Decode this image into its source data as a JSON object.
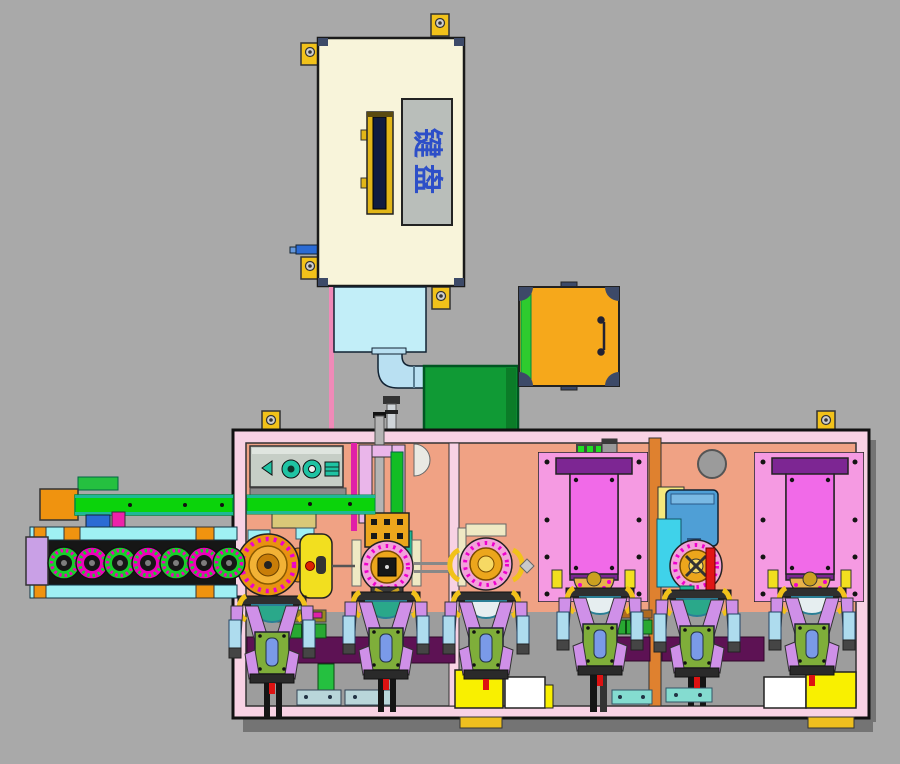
{
  "machine_label": {
    "text": "键盘"
  },
  "components": {
    "feeder": "feeder-box",
    "chute": "vibration-chute",
    "pipe": "elbow-pipe",
    "cabinet": "green-cabinet",
    "cover": "orange-cover",
    "frame": "machine-frame",
    "conveyor": "chain-conveyor",
    "press": "press-station",
    "turret": "turret-station",
    "plates": "fixture-plate",
    "grippers": "gripper-unit"
  },
  "colors": {
    "bg": "#a9a9a9",
    "shadow": "#747474",
    "frame-pink": "#f8d2e4",
    "salmon": "#f0a284",
    "gray-band": "#9d9d9d",
    "cream": "#f8f4da",
    "gold-tab": "#f2c21a",
    "rail-gold": "#e2b618",
    "navy": "#101c40",
    "label-gray": "#b9beba",
    "label-blue": "#2d4fc8",
    "chute": "#c2eef8",
    "pipe": "#b9e0f2",
    "green-box": "#109a35",
    "orange-box": "#f6a81b",
    "green-strip": "#2ecb2e",
    "slate": "#3d4a68",
    "beam-green": "#0bd30b",
    "teal": "#1fb896",
    "cyan-rail": "#9ff0f4",
    "orange-block": "#f0930f",
    "bed-dark": "#161616",
    "lavender": "#c9a0e6",
    "panel-gray": "#c6cec6",
    "comp-teal": "#1fc3a3",
    "violet-plate": "#eab6ea",
    "rod-gray": "#b4b4b4",
    "gold-part": "#eca61c",
    "station-pink": "#f2a2da",
    "dot-magenta": "#ee00cc",
    "ivory": "#efe9c4",
    "khaki": "#d9c878",
    "turret-orange": "#e89211",
    "yellow-d": "#f2df1f",
    "red": "#e01515",
    "magenta": "#e020a8",
    "plate-pink": "#f59ae2",
    "purple": "#7d2693",
    "magenta-panel": "#f16ae8",
    "led-green": "#22dd22",
    "chip-gray": "#9a9a9a",
    "bar-purple": "#5d1254",
    "gripper-violet": "#cf90e8",
    "clamp-blue": "#aedcee",
    "body-green": "#7fae3a",
    "slot-blue": "#7a9ae8",
    "cup-teal": "#2aa88a",
    "cup-light": "#e6eef0",
    "yellow-box": "#f9f000",
    "white": "#ffffff",
    "teal-plate": "#84dcd0",
    "steel-blue": "#4f9fd6",
    "cyan-block": "#3fd2ea",
    "divider-orange": "#df812f",
    "pad-gold": "#eebf1f",
    "tube-magenta": "#f08ab8",
    "brown": "#b06a20",
    "part-blue": "#2b6bd4",
    "gear-green": "#17cf2a",
    "gear-magenta": "#ee00bb"
  }
}
